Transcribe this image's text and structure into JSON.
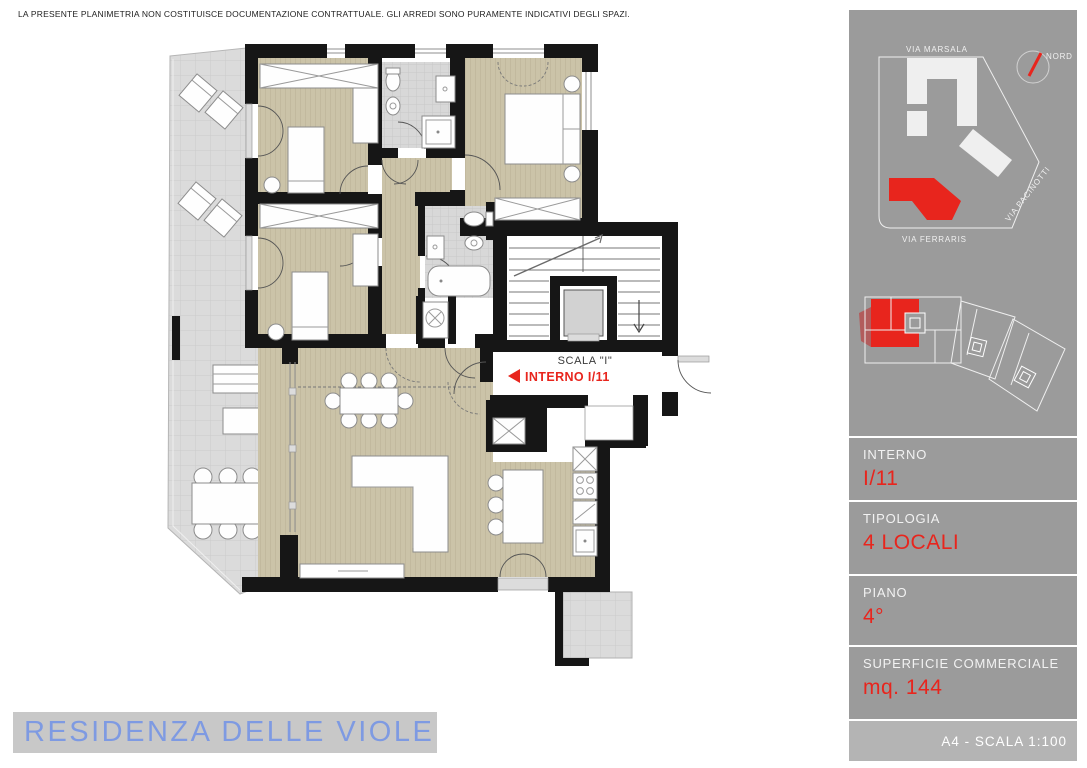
{
  "disclaimer": "LA PRESENTE PLANIMETRIA NON COSTITUISCE DOCUMENTAZIONE CONTRATTUALE. GLI ARREDI SONO PURAMENTE INDICATIVI DEGLI SPAZI.",
  "plan": {
    "stair_label": "SCALA \"I\"",
    "unit_label": "INTERNO I/11"
  },
  "sidebar": {
    "site_map": {
      "streets": [
        "VIA MARSALA",
        "VIA FERRARIS",
        "VIA PACINOTTI"
      ],
      "compass": "NORD"
    },
    "info_panels": [
      {
        "label": "INTERNO",
        "value": "I/11"
      },
      {
        "label": "TIPOLOGIA",
        "value": "4 LOCALI"
      },
      {
        "label": "PIANO",
        "value": "4°"
      },
      {
        "label": "SUPERFICIE COMMERCIALE",
        "value": "mq. 144"
      }
    ],
    "footer": "A4 - SCALA 1:100"
  },
  "footer": {
    "title": "RESIDENZA DELLE VIOLE"
  },
  "colors": {
    "accent_red": "#e8251d",
    "muted_red": "#b25c5c",
    "title_blue": "#7e9ae2",
    "sidebar_gray": "#9b9b9b",
    "footer_strip_gray": "#b4b4b4",
    "titlebar_gray": "#c8c8c8",
    "floor_beige": "#cbc3a8",
    "terrace_gray": "#dbdbdb",
    "wall_black": "#161616"
  }
}
